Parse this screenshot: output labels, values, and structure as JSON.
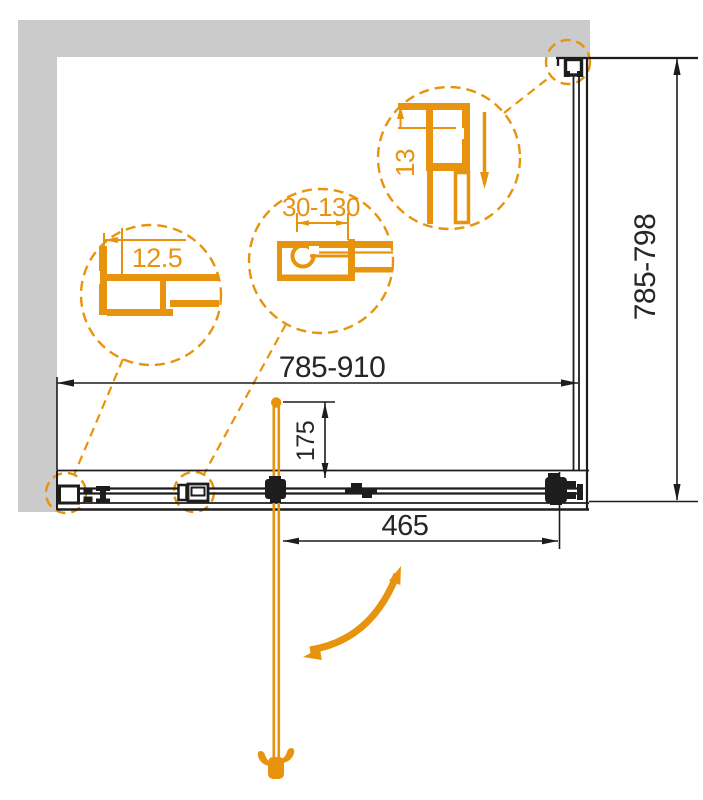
{
  "meta": {
    "title": "Shower enclosure sliding door technical drawing",
    "canvas": {
      "width": 703,
      "height": 800
    }
  },
  "colors": {
    "accent_orange": "#E8930E",
    "line_black": "#1D1D1D",
    "wall_gray": "#CBCBCB",
    "background": "#FFFFFF"
  },
  "dimensions": {
    "overall_width": {
      "label": "785-910"
    },
    "overall_height": {
      "label": "785-798"
    },
    "door_width": {
      "label": "465"
    },
    "handle_offset": {
      "label": "175"
    }
  },
  "callouts": {
    "wall_profile": {
      "label": "12.5"
    },
    "adjustment_range": {
      "label": "30-130"
    },
    "top_rail": {
      "label": "13"
    }
  }
}
